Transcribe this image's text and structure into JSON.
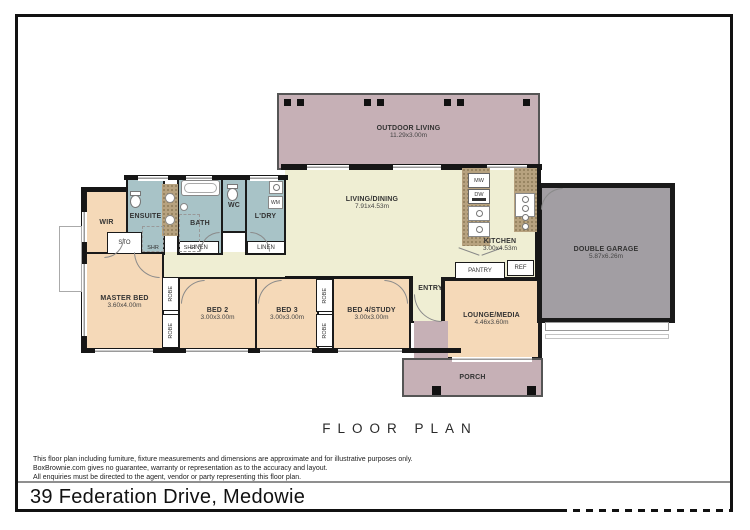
{
  "title": "FLOOR PLAN",
  "address": "39 Federation Drive, Medowie",
  "disclaimer": {
    "line1": "This floor plan including furniture, fixture measurements and dimensions are approximate and for illustrative purposes only.",
    "line2": "BoxBrownie.com gives no guarantee, warranty or representation as to the accuracy and layout.",
    "line3": "All enquiries must be directed to the agent, vendor or party representing this floor plan."
  },
  "rooms": {
    "outdoor_living": {
      "name": "OUTDOOR LIVING",
      "dims": "11.29x3.00m"
    },
    "living_dining": {
      "name": "LIVING/DINING",
      "dims": "7.91x4.53m"
    },
    "kitchen": {
      "name": "KITCHEN",
      "dims": "3.00x4.53m"
    },
    "double_garage": {
      "name": "DOUBLE GARAGE",
      "dims": "5.87x6.26m"
    },
    "master_bed": {
      "name": "MASTER BED",
      "dims": "3.60x4.00m"
    },
    "bed2": {
      "name": "BED 2",
      "dims": "3.00x3.00m"
    },
    "bed3": {
      "name": "BED 3",
      "dims": "3.00x3.00m"
    },
    "bed4": {
      "name": "BED 4/STUDY",
      "dims": "3.00x3.00m"
    },
    "lounge_media": {
      "name": "LOUNGE/MEDIA",
      "dims": "4.46x3.60m"
    },
    "entry": {
      "name": "ENTRY"
    },
    "porch": {
      "name": "PORCH"
    },
    "wir": {
      "name": "WIR"
    },
    "ensuite": {
      "name": "ENSUITE"
    },
    "bath": {
      "name": "BATH"
    },
    "wc": {
      "name": "WC"
    },
    "ldry": {
      "name": "L'DRY"
    }
  },
  "fixtures": {
    "sto": "STO",
    "shr": "SHR",
    "robe": "ROBE",
    "linen": "LINEN",
    "pantry": "PANTRY",
    "ref": "REF",
    "mw": "MW",
    "dw": "DW",
    "wm": "WM"
  },
  "colors": {
    "wall": "#161616",
    "outdoor": "#c6b0b6",
    "living": "#efeed3",
    "bedroom": "#f5d9b8",
    "wet_area": "#a8c3c7",
    "garage": "#a29ea3",
    "bench": "#b7a27f"
  }
}
